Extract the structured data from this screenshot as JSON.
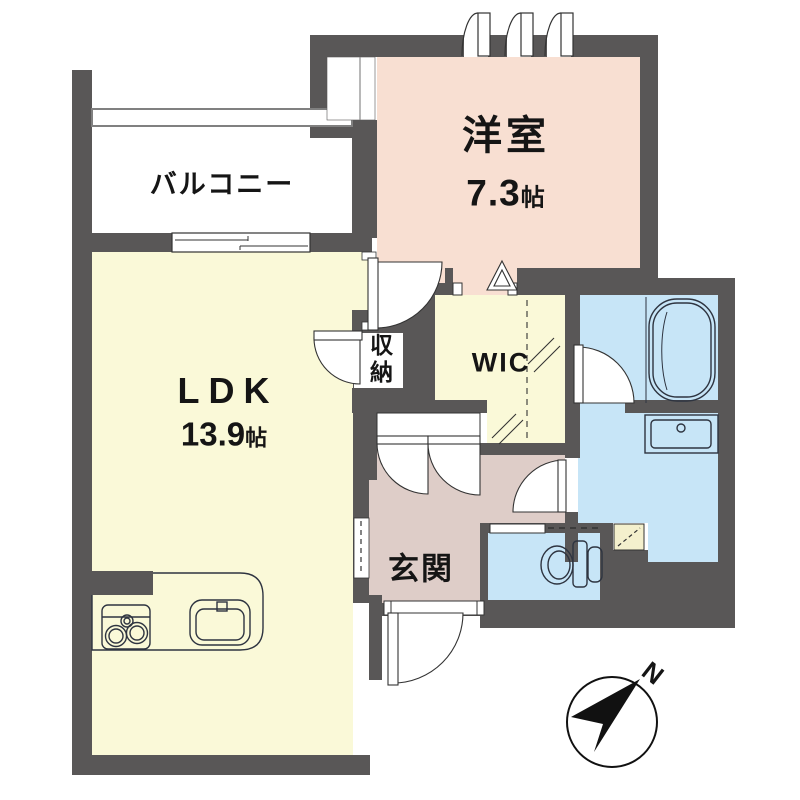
{
  "floor_plan": {
    "title": "apartment-floor-plan",
    "rooms": {
      "balcony": {
        "label": "バルコニー"
      },
      "western_room": {
        "label": "洋室",
        "area_value": "7.3",
        "area_unit": "帖"
      },
      "ldk": {
        "label": "LDK",
        "area_value": "13.9",
        "area_unit": "帖"
      },
      "wic": {
        "label": "WIC"
      },
      "storage": {
        "label": "収納"
      },
      "entrance": {
        "label": "玄関"
      }
    },
    "compass": {
      "north_label": "N"
    },
    "colors": {
      "wall": "#595757",
      "ldk_fill": "#FAF9D8",
      "western_room_fill": "#F8DFD2",
      "entrance_fill": "#DECDC8",
      "wet_area_fill": "#C7E5F7",
      "niche_fill": "#F4F0CD",
      "line": "#333333"
    }
  }
}
